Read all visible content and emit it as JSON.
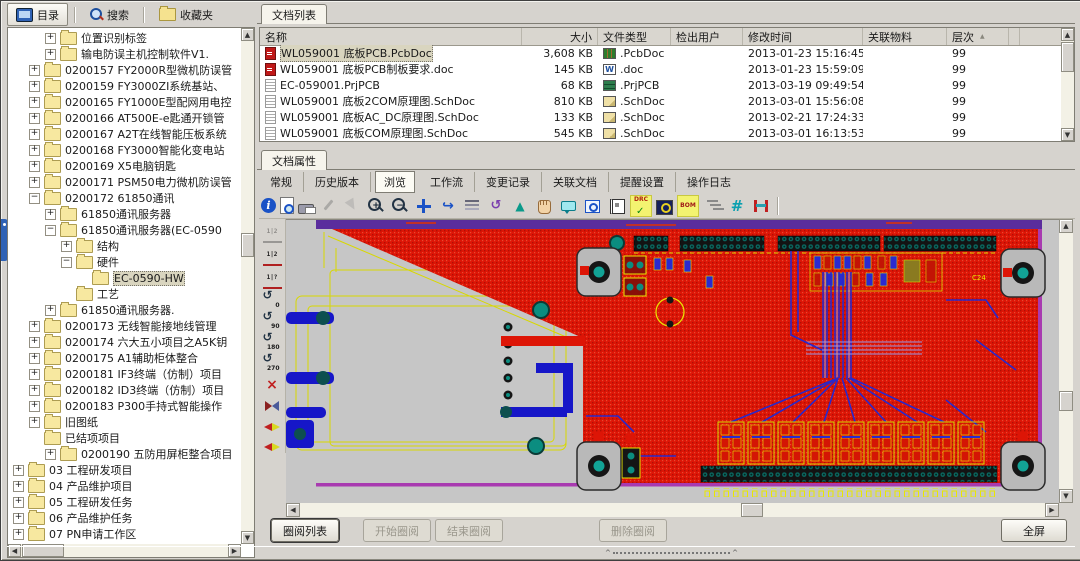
{
  "colors": {
    "chrome": "#d6d3ce",
    "accent_blue": "#2f62b5",
    "pcb_red": "#dd1506",
    "pcb_red_dark": "#b01004",
    "pcb_blue": "#2a2ad0",
    "pcb_yellow": "#e8e800",
    "pcb_gray": "#c6c6c6",
    "pcb_purple_band": "#5a2d9d",
    "pcb_magenta": "#a83ab0",
    "pcb_teal": "#12a396",
    "selection": "#d9d5bf"
  },
  "left_toolbar": {
    "buttons": [
      {
        "label": "目录",
        "icon": "directory",
        "active": true
      },
      {
        "label": "搜索",
        "icon": "search",
        "active": false
      },
      {
        "label": "收藏夹",
        "icon": "favorites",
        "active": false
      }
    ]
  },
  "tree": {
    "items": [
      {
        "label": "位置识别标签",
        "level": 3,
        "expand": "plus"
      },
      {
        "label": "输电防误主机控制软件V1.",
        "level": 3,
        "expand": "plus"
      },
      {
        "label": "0200157  FY2000R型微机防误管",
        "level": 2,
        "expand": "plus"
      },
      {
        "label": "0200159  FY3000ZI系统基站、",
        "level": 2,
        "expand": "plus"
      },
      {
        "label": "0200165  FY1000E型配网用电控",
        "level": 2,
        "expand": "plus"
      },
      {
        "label": "0200166  AT500E-e匙通开锁管",
        "level": 2,
        "expand": "plus"
      },
      {
        "label": "0200167  A2T在线智能压板系统",
        "level": 2,
        "expand": "plus"
      },
      {
        "label": "0200168  FY3000智能化变电站",
        "level": 2,
        "expand": "plus"
      },
      {
        "label": "0200169  X5电脑钥匙",
        "level": 2,
        "expand": "plus"
      },
      {
        "label": "0200171  PSM50电力微机防误管",
        "level": 2,
        "expand": "plus"
      },
      {
        "label": "0200172  61850通讯",
        "level": 2,
        "expand": "minus"
      },
      {
        "label": "61850通讯服务器",
        "level": 3,
        "expand": "plus"
      },
      {
        "label": "61850通讯服务器(EC-0590",
        "level": 3,
        "expand": "minus"
      },
      {
        "label": "结构",
        "level": 4,
        "expand": "plus"
      },
      {
        "label": "硬件",
        "level": 4,
        "expand": "minus"
      },
      {
        "label": "EC-0590-HW",
        "level": 5,
        "expand": "none",
        "selected": true
      },
      {
        "label": "工艺",
        "level": 4,
        "expand": "none"
      },
      {
        "label": "61850通讯服务器.",
        "level": 3,
        "expand": "plus"
      },
      {
        "label": "0200173  无线智能接地线管理",
        "level": 2,
        "expand": "plus"
      },
      {
        "label": "0200174  六大五小项目之A5K钥",
        "level": 2,
        "expand": "plus"
      },
      {
        "label": "0200175  A1辅助柜体整合",
        "level": 2,
        "expand": "plus"
      },
      {
        "label": "0200181  IF3终端（仿制）项目",
        "level": 2,
        "expand": "plus"
      },
      {
        "label": "0200182  ID3终端（仿制）项目",
        "level": 2,
        "expand": "plus"
      },
      {
        "label": "0200183  P300手持式智能操作",
        "level": 2,
        "expand": "plus"
      },
      {
        "label": "旧图纸",
        "level": 2,
        "expand": "plus"
      },
      {
        "label": "已结项项目",
        "level": 2,
        "expand": "none"
      },
      {
        "label": "0200190  五防用屏柜整合项目",
        "level": 3,
        "expand": "plus"
      },
      {
        "label": "03 工程研发项目",
        "level": 1,
        "expand": "plus"
      },
      {
        "label": "04 产品维护项目",
        "level": 1,
        "expand": "plus"
      },
      {
        "label": "05 工程研发任务",
        "level": 1,
        "expand": "plus"
      },
      {
        "label": "06 产品维护任务",
        "level": 1,
        "expand": "plus"
      },
      {
        "label": "07 PN申请工作区",
        "level": 1,
        "expand": "plus"
      }
    ]
  },
  "doc_list": {
    "tab": "文档列表",
    "columns": [
      "名称",
      "大小",
      "文件类型",
      "检出用户",
      "修改时间",
      "关联物料",
      "层次"
    ],
    "sorted_column": "层次",
    "rows": [
      {
        "name": "WL059001 底板PCB.PcbDoc",
        "name_icon": "red-doc",
        "size": "3,608 KB",
        "type": ".PcbDoc",
        "type_icon": "pcbdoc",
        "checked_out_by": "",
        "modified": "2013-01-23 15:16:45",
        "material": "",
        "level": "99",
        "selected": true
      },
      {
        "name": "WL059001 底板PCB制板要求.doc",
        "name_icon": "red-doc",
        "size": "145 KB",
        "type": ".doc",
        "type_icon": "word",
        "checked_out_by": "",
        "modified": "2013-01-23 15:59:09",
        "material": "",
        "level": "99"
      },
      {
        "name": "EC-059001.PrjPCB",
        "name_icon": "doc-lines",
        "size": "68 KB",
        "type": ".PrjPCB",
        "type_icon": "prjpcb",
        "checked_out_by": "",
        "modified": "2013-03-19 09:49:54",
        "material": "",
        "level": "99"
      },
      {
        "name": "WL059001 底板2COM原理图.SchDoc",
        "name_icon": "doc-lines",
        "size": "810 KB",
        "type": ".SchDoc",
        "type_icon": "schdoc",
        "checked_out_by": "",
        "modified": "2013-03-01 15:56:08",
        "material": "",
        "level": "99"
      },
      {
        "name": "WL059001 底板AC_DC原理图.SchDoc",
        "name_icon": "doc-lines",
        "size": "133 KB",
        "type": ".SchDoc",
        "type_icon": "schdoc",
        "checked_out_by": "",
        "modified": "2013-02-21 17:24:33",
        "material": "",
        "level": "99"
      },
      {
        "name": "WL059001 底板COM原理图.SchDoc",
        "name_icon": "doc-lines",
        "size": "545 KB",
        "type": ".SchDoc",
        "type_icon": "schdoc",
        "checked_out_by": "",
        "modified": "2013-03-01 16:13:53",
        "material": "",
        "level": "99"
      }
    ]
  },
  "doc_props": {
    "tab": "文档属性",
    "subtabs": [
      "常规",
      "历史版本",
      "浏览",
      "工作流",
      "变更记录",
      "关联文档",
      "提醒设置",
      "操作日志"
    ],
    "active_subtab": "浏览"
  },
  "viewer": {
    "toolbar": [
      {
        "name": "info",
        "text": "i"
      },
      {
        "name": "print-preview"
      },
      {
        "name": "print"
      },
      {
        "name": "edit",
        "disabled": true
      },
      {
        "name": "pointer",
        "disabled": true
      },
      {
        "name": "zoom-in",
        "text": "+"
      },
      {
        "name": "zoom-out",
        "text": "−"
      },
      {
        "name": "pan"
      },
      {
        "name": "rotate"
      },
      {
        "name": "layers"
      },
      {
        "name": "redline"
      },
      {
        "name": "arrow-up"
      },
      {
        "name": "hand"
      },
      {
        "name": "comment"
      },
      {
        "name": "zoom-window"
      },
      {
        "name": "notebook"
      },
      {
        "name": "drc",
        "text": "DRC"
      },
      {
        "name": "board-view"
      },
      {
        "name": "bom",
        "text": "BOM"
      },
      {
        "name": "layer-tree"
      },
      {
        "name": "grid",
        "text": "#"
      },
      {
        "name": "measure"
      }
    ],
    "side_toolbar": [
      {
        "name": "compare-none",
        "text": "1|2",
        "disabled": true
      },
      {
        "name": "compare-12",
        "text": "1|2"
      },
      {
        "name": "compare-1q",
        "text": "1|?"
      },
      {
        "name": "rotate-0",
        "text": "0"
      },
      {
        "name": "rotate-90",
        "text": "90"
      },
      {
        "name": "rotate-180",
        "text": "180"
      },
      {
        "name": "rotate-270",
        "text": "270"
      },
      {
        "name": "mirror-off",
        "text": "×"
      },
      {
        "name": "mirror-h"
      },
      {
        "name": "mirror-left"
      },
      {
        "name": "mirror-right"
      }
    ],
    "labels": {
      "c24": "C24"
    }
  },
  "review_bar": {
    "buttons": [
      {
        "label": "圈阅列表",
        "enabled": true
      },
      {
        "label": "开始圈阅",
        "enabled": false
      },
      {
        "label": "结束圈阅",
        "enabled": false
      },
      {
        "label": "删除圈阅",
        "enabled": false
      }
    ],
    "fullscreen_label": "全屏"
  }
}
